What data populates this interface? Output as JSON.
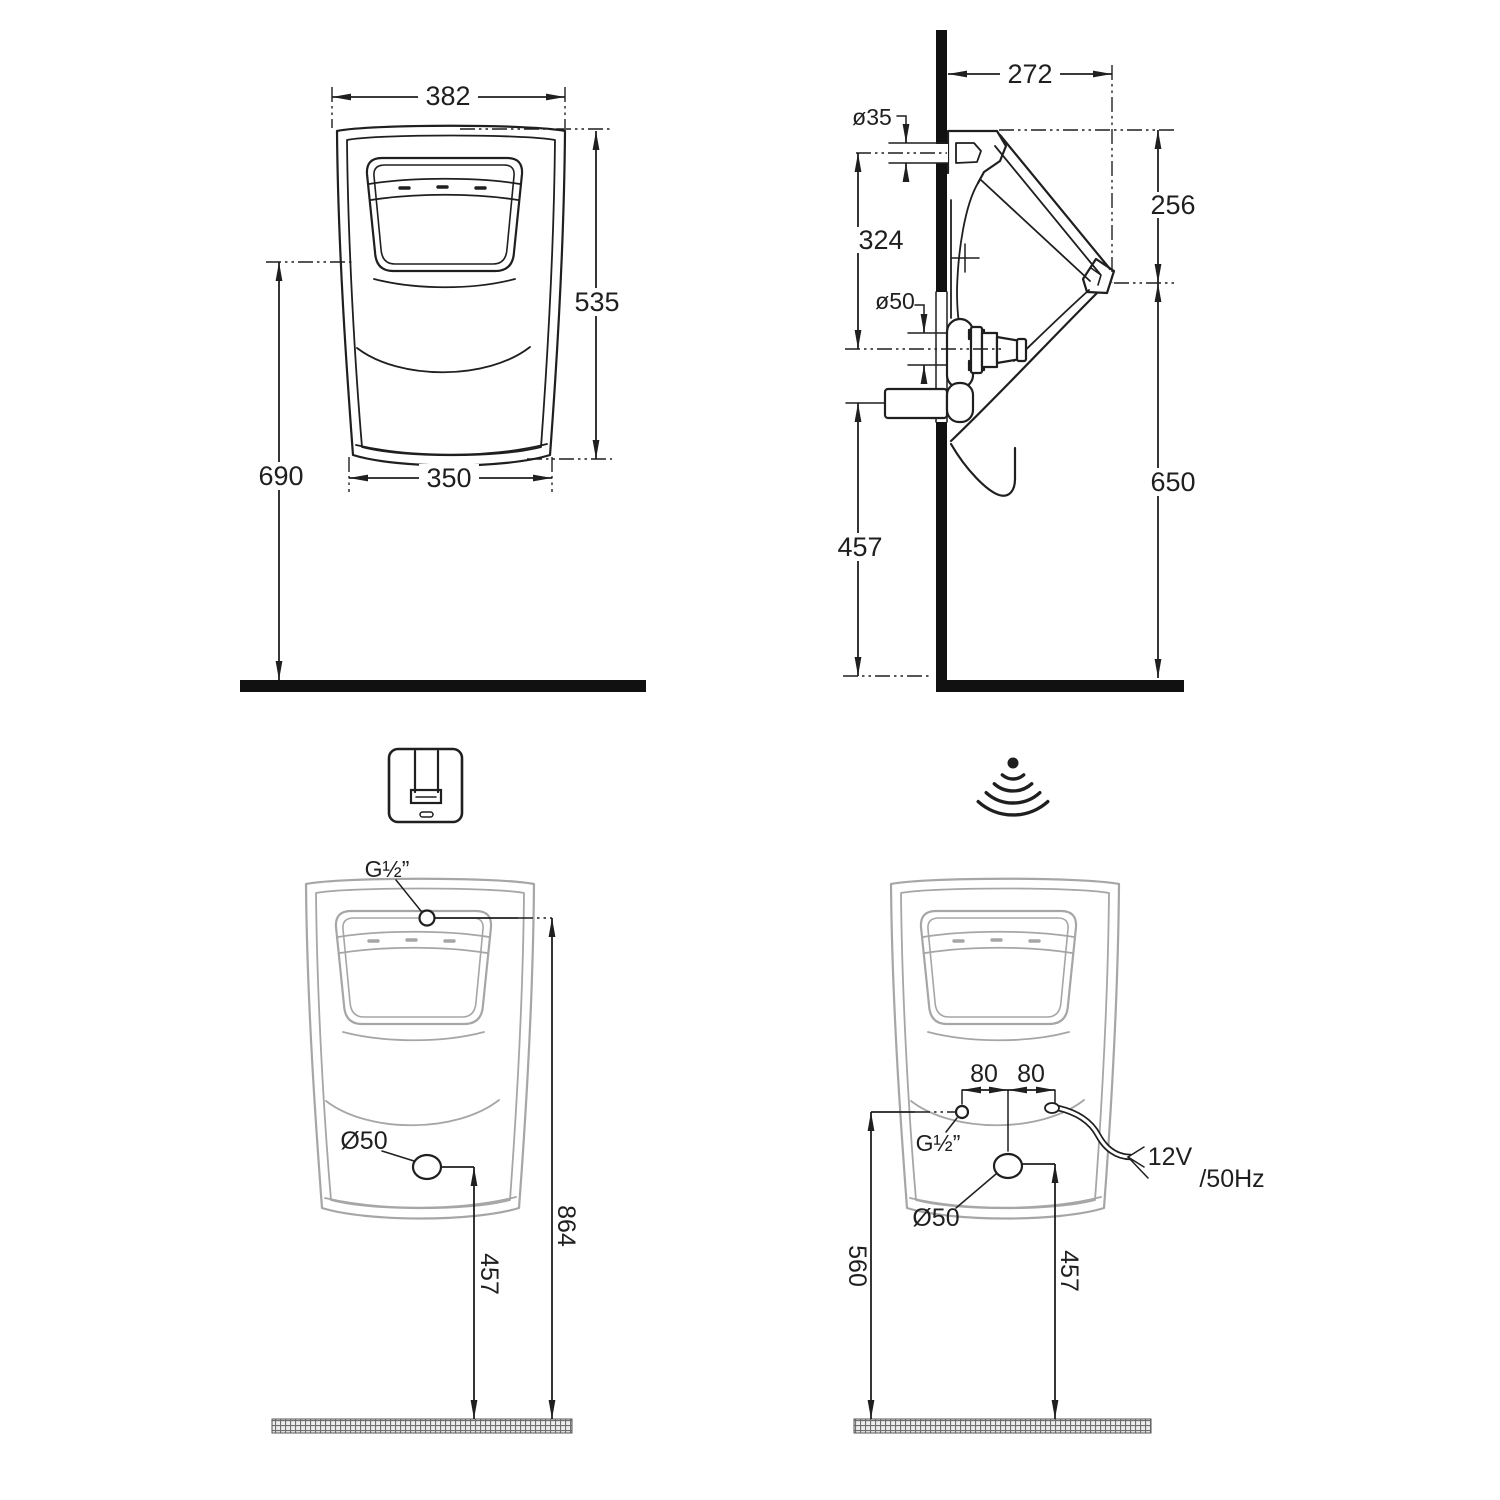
{
  "drawing": {
    "front": {
      "top_width": "382",
      "height": "535",
      "bottom_width": "350",
      "rim_height": "690"
    },
    "side": {
      "depth": "272",
      "inlet_diameter": "ø35",
      "inlet_to_drain": "324",
      "drain_diameter": "ø50",
      "top_to_spout": "256",
      "spout_height": "650",
      "drain_height": "457"
    },
    "manual": {
      "inlet_thread": "G½”",
      "outlet_diameter": "Ø50",
      "inlet_height": "864",
      "outlet_height": "457"
    },
    "sensor": {
      "offset_left": "80",
      "offset_right": "80",
      "inlet_thread": "G½”",
      "outlet_diameter": "Ø50",
      "voltage": "12V",
      "frequency": "/50Hz",
      "inlet_height": "560",
      "outlet_height": "457"
    },
    "icons": {
      "manual_flush": "manual-flush-valve-icon",
      "sensor_flush": "infrared-sensor-icon"
    },
    "colors": {
      "line": "#1f1f1f",
      "light_outline": "#a6a6a6",
      "background": "#ffffff"
    }
  }
}
